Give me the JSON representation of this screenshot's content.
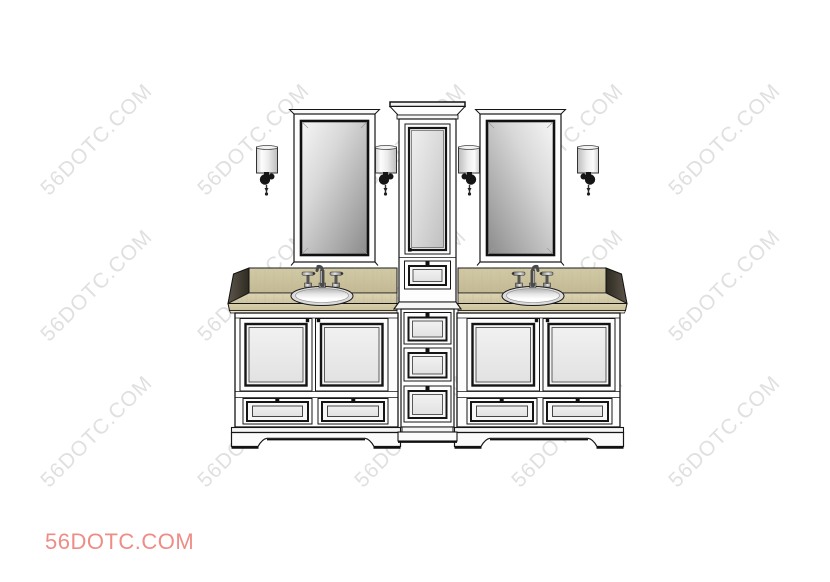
{
  "watermark": {
    "text": "56DOTC.COM",
    "color": "#e0e0e0"
  },
  "brand": {
    "text": "56DOTC.COM",
    "color": "#ee8d86"
  },
  "scene": {
    "description": "Line-art product render of a white double-sink bathroom vanity with a center tower cabinet, two beveled mirrors and four wall sconces on a tan wood countertop",
    "colors": {
      "background": "#ffffff",
      "outline": "#151515",
      "cabinet": "#fdfdfd",
      "panel_light": "#ececec",
      "counter_tan": "#d5cca9",
      "backsplash_tan": "#cbc29e",
      "counter_side_dark": "#443e32",
      "mirror_glass_light": "#f4f4f4",
      "mirror_glass_dark": "#8a8a8a",
      "sconce_shade": "#ededed",
      "sconce_bracket": "#111111",
      "knob": "#111111"
    }
  }
}
